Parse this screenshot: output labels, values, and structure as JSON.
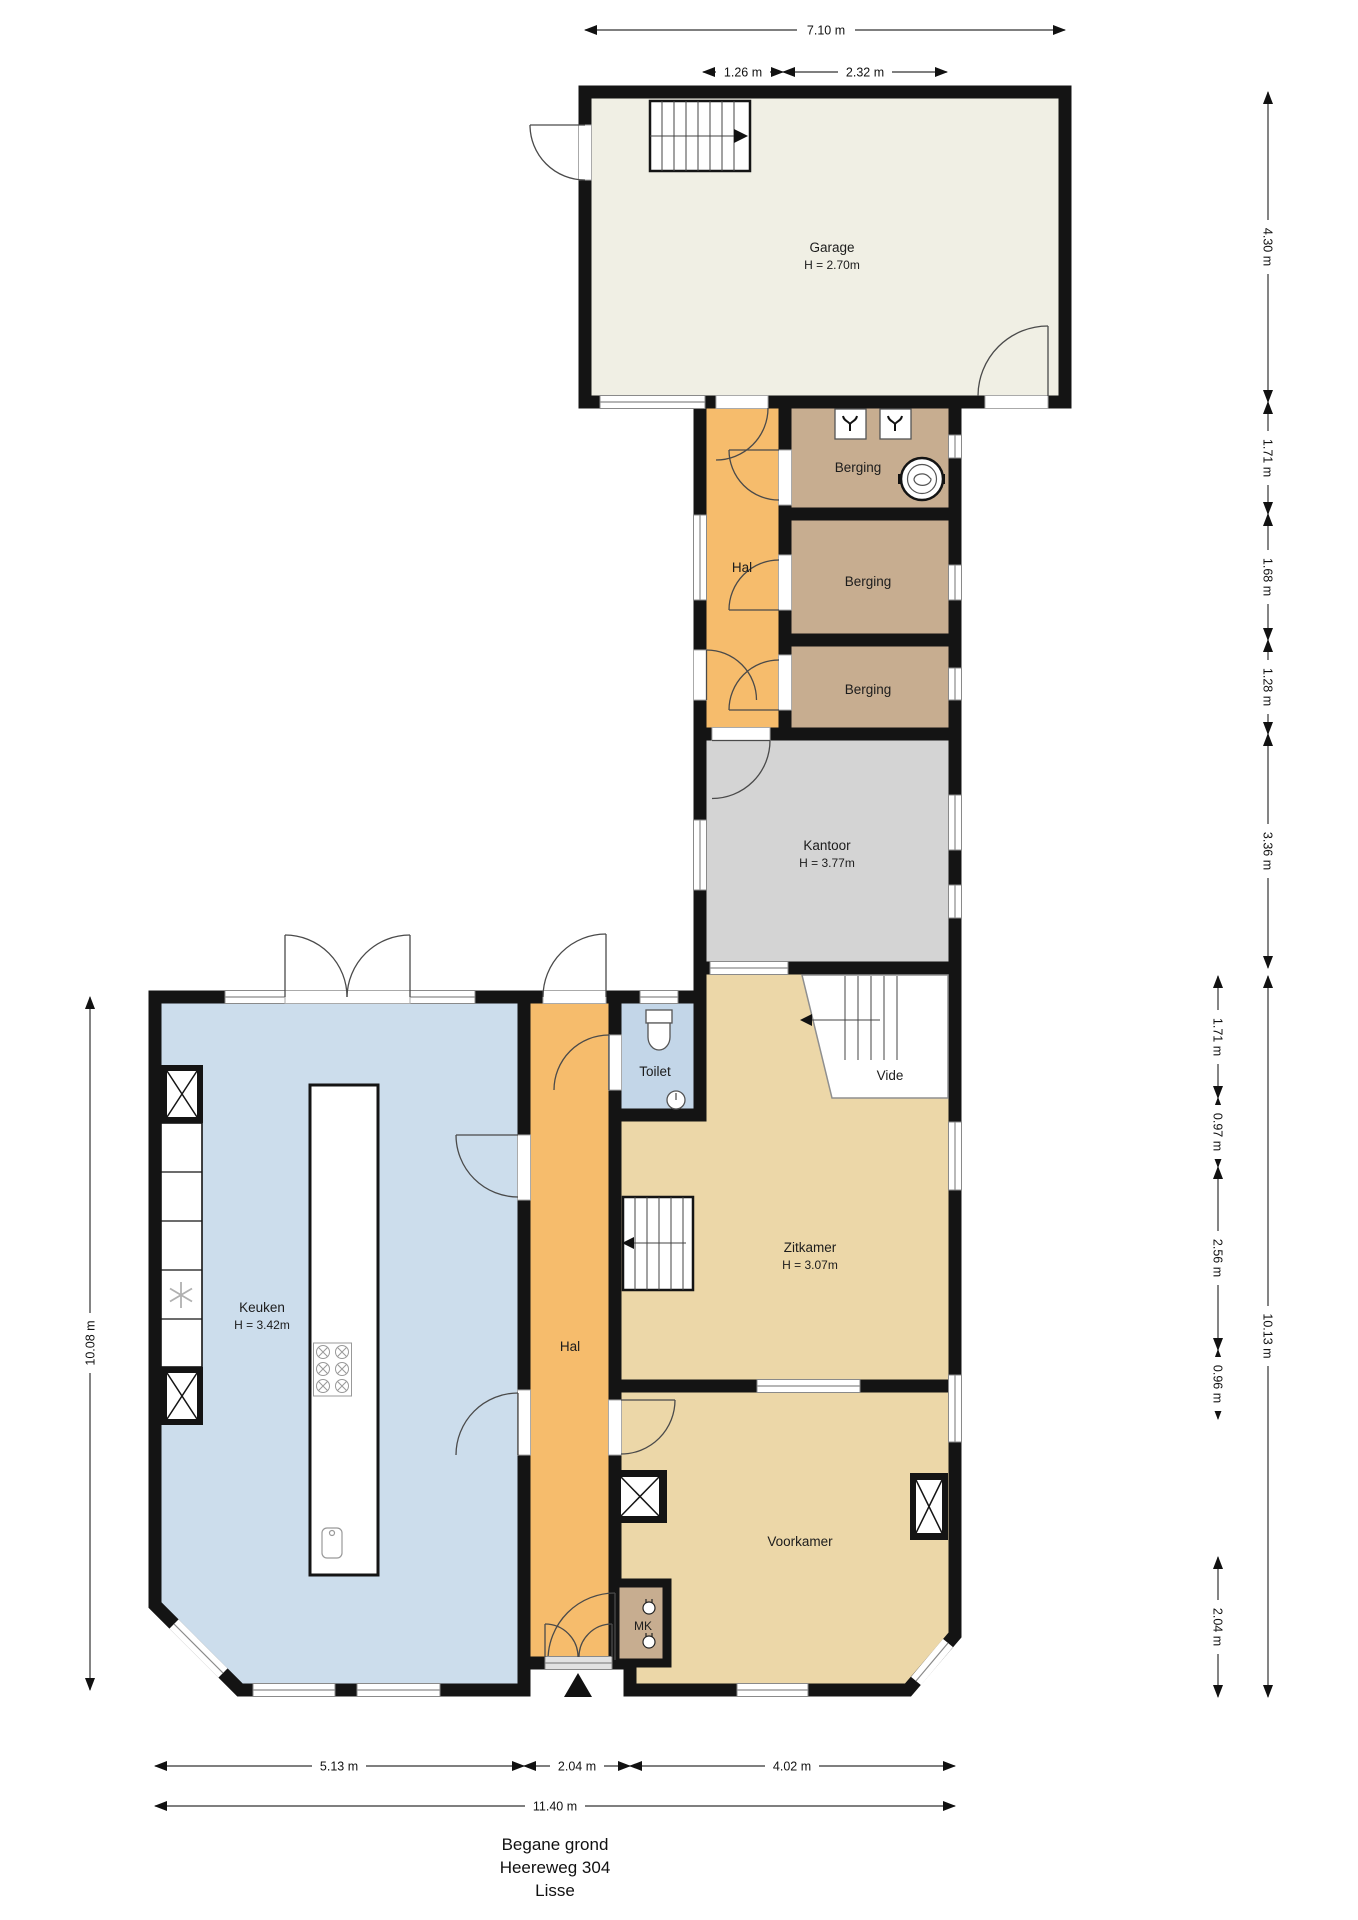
{
  "title": {
    "line1": "Begane grond",
    "line2": "Heereweg 304",
    "line3": "Lisse"
  },
  "rooms": {
    "garage": {
      "name": "Garage",
      "height": "H = 2.70m"
    },
    "hal_upper": {
      "name": "Hal"
    },
    "berging1": {
      "name": "Berging"
    },
    "berging2": {
      "name": "Berging"
    },
    "berging3": {
      "name": "Berging"
    },
    "kantoor": {
      "name": "Kantoor",
      "height": "H = 3.77m"
    },
    "keuken": {
      "name": "Keuken",
      "height": "H = 3.42m"
    },
    "hal_lower": {
      "name": "Hal"
    },
    "toilet": {
      "name": "Toilet"
    },
    "vide": {
      "name": "Vide"
    },
    "zitkamer": {
      "name": "Zitkamer",
      "height": "H = 3.07m"
    },
    "voorkamer": {
      "name": "Voorkamer"
    },
    "mk": {
      "name": "MK"
    }
  },
  "dims": {
    "top_total": "7.10 m",
    "top_seg1": "1.26 m",
    "top_seg2": "2.32 m",
    "right_upper": [
      "4.30 m",
      "1.71 m",
      "1.68 m",
      "1.28 m",
      "3.36 m"
    ],
    "left_total": "10.08 m",
    "right_lower_inner": [
      "1.71 m",
      "0.97 m",
      "2.56 m",
      "0.96 m",
      "2.04 m"
    ],
    "right_lower_total": "10.13 m",
    "bottom_segments": [
      "5.13 m",
      "2.04 m",
      "4.02 m"
    ],
    "bottom_total": "11.40 m"
  },
  "icons": {
    "entrance-marker": "solid upward triangle at front door",
    "washer-connection": "square with tap glyph (2x in first Berging)",
    "boiler": "double circle fixture in first Berging",
    "freezer": "snowflake in kitchen cabinet run",
    "shaft": "box with X (chimneys / ducts)"
  },
  "colors": {
    "walls": "#141414",
    "garage": "#f0efe4",
    "hal": "#f6bc6c",
    "berging": "#c7ad90",
    "kantoor": "#d4d4d4",
    "keuken": "#ccddec",
    "toilet": "#c3d6e8",
    "living": "#ecd7a8",
    "mk": "#c7ad90",
    "window": "#8a8a8a"
  }
}
